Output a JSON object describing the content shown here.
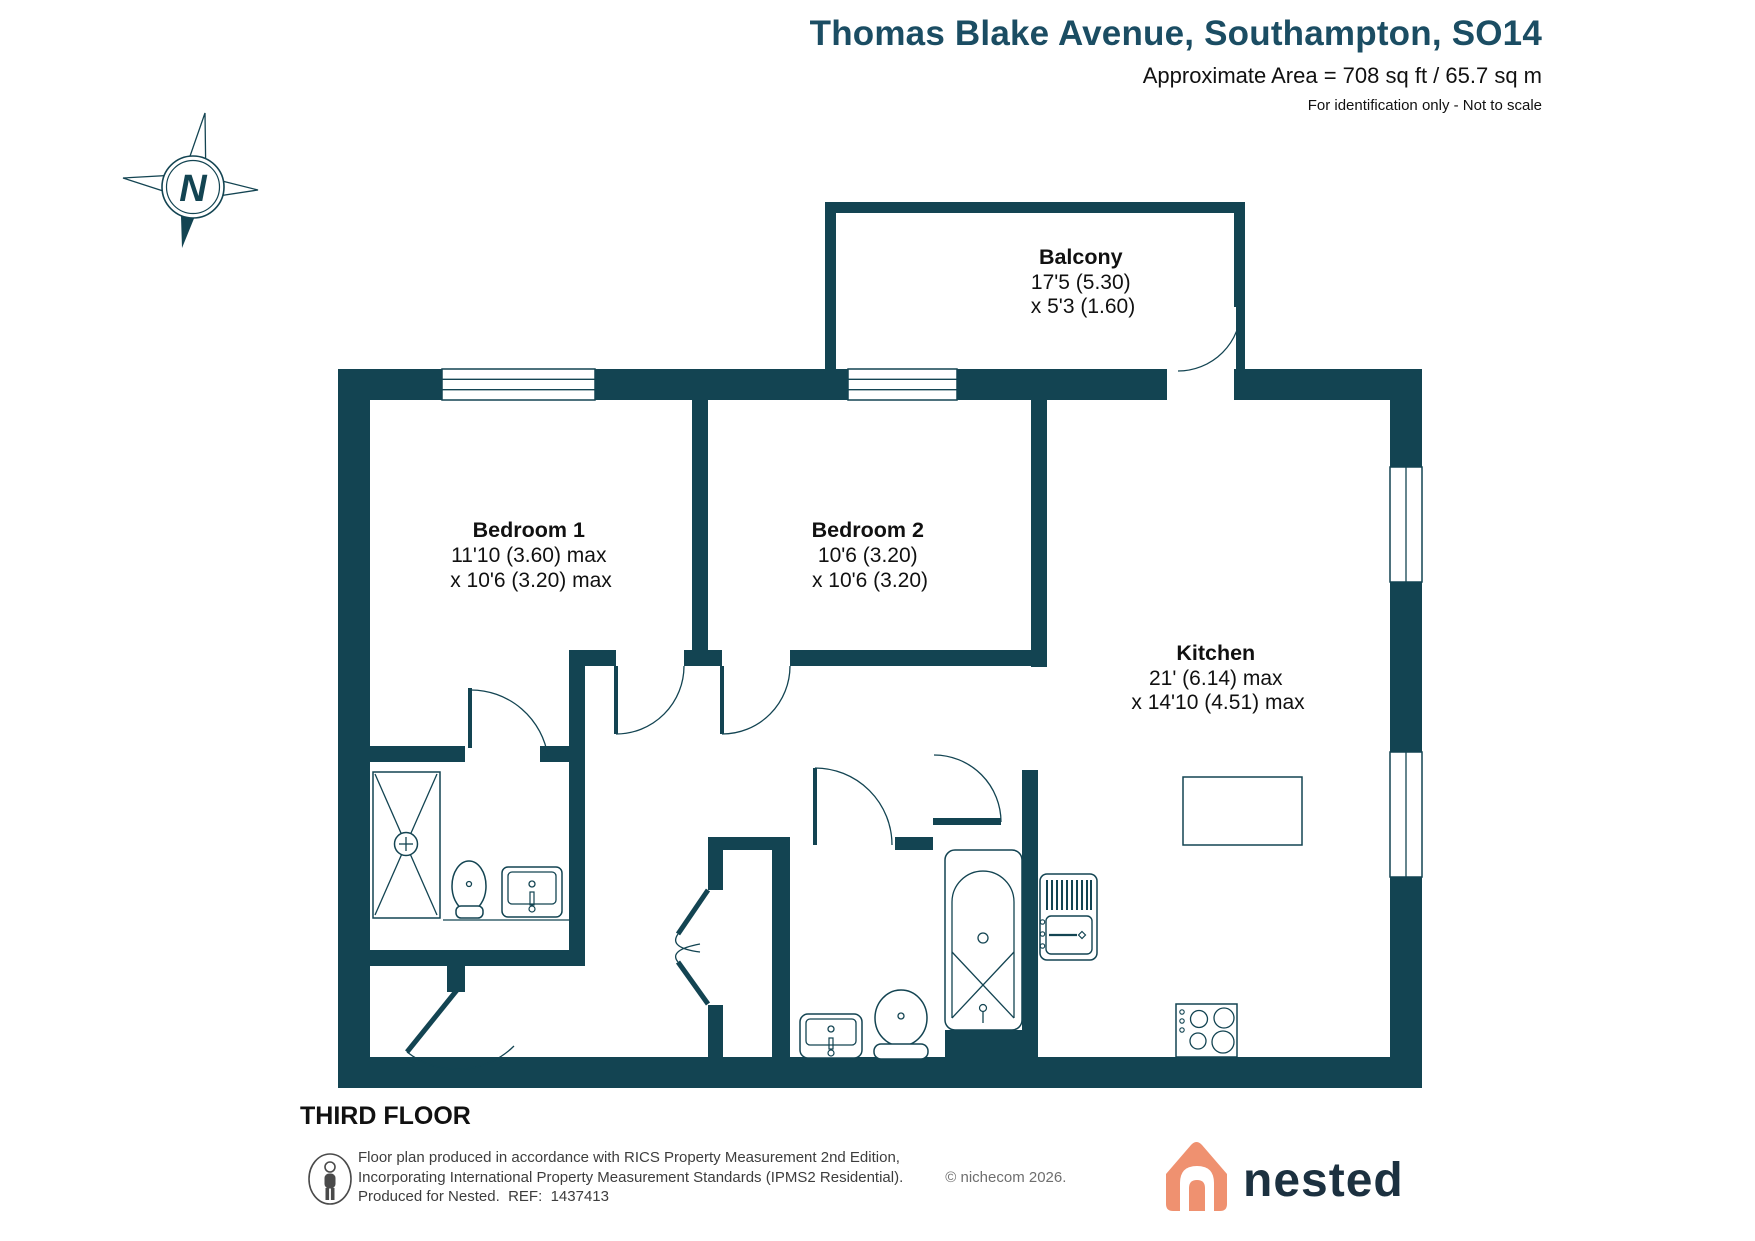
{
  "header": {
    "title": "Thomas Blake Avenue, Southampton, SO14",
    "area": "Approximate Area = 708 sq ft / 65.7 sq m",
    "note": "For identification only - Not to scale"
  },
  "compass": {
    "label": "N"
  },
  "plan": {
    "floor_label": "THIRD FLOOR",
    "rooms": {
      "balcony": {
        "name": "Balcony",
        "dims": [
          "17'5 (5.30)",
          "x 5'3 (1.60)"
        ]
      },
      "bedroom1": {
        "name": "Bedroom 1",
        "dims": [
          "11'10 (3.60) max",
          "x 10'6 (3.20) max"
        ]
      },
      "bedroom2": {
        "name": "Bedroom 2",
        "dims": [
          "10'6 (3.20)",
          "x 10'6 (3.20)"
        ]
      },
      "kitchen": {
        "name": "Kitchen",
        "dims": [
          "21' (6.14) max",
          "x 14'10 (4.51) max"
        ]
      }
    },
    "fixtures": [
      "shower",
      "toilet",
      "basin",
      "bath",
      "kitchen-sink-unit",
      "island",
      "hob",
      "bifold-cupboard"
    ]
  },
  "footer": {
    "line1": "Floor plan produced in accordance with RICS Property Measurement 2nd Edition,",
    "line2": "Incorporating International Property Measurement Standards (IPMS2 Residential).",
    "copyright": "© nichecom 2026.",
    "line3": "Produced for Nested.  REF:  1437413",
    "brand": "nested"
  },
  "colors": {
    "wall": "#134452",
    "title": "#1b4d63",
    "brand_orange": "#ef9170",
    "brand_navy": "#1c3140"
  }
}
